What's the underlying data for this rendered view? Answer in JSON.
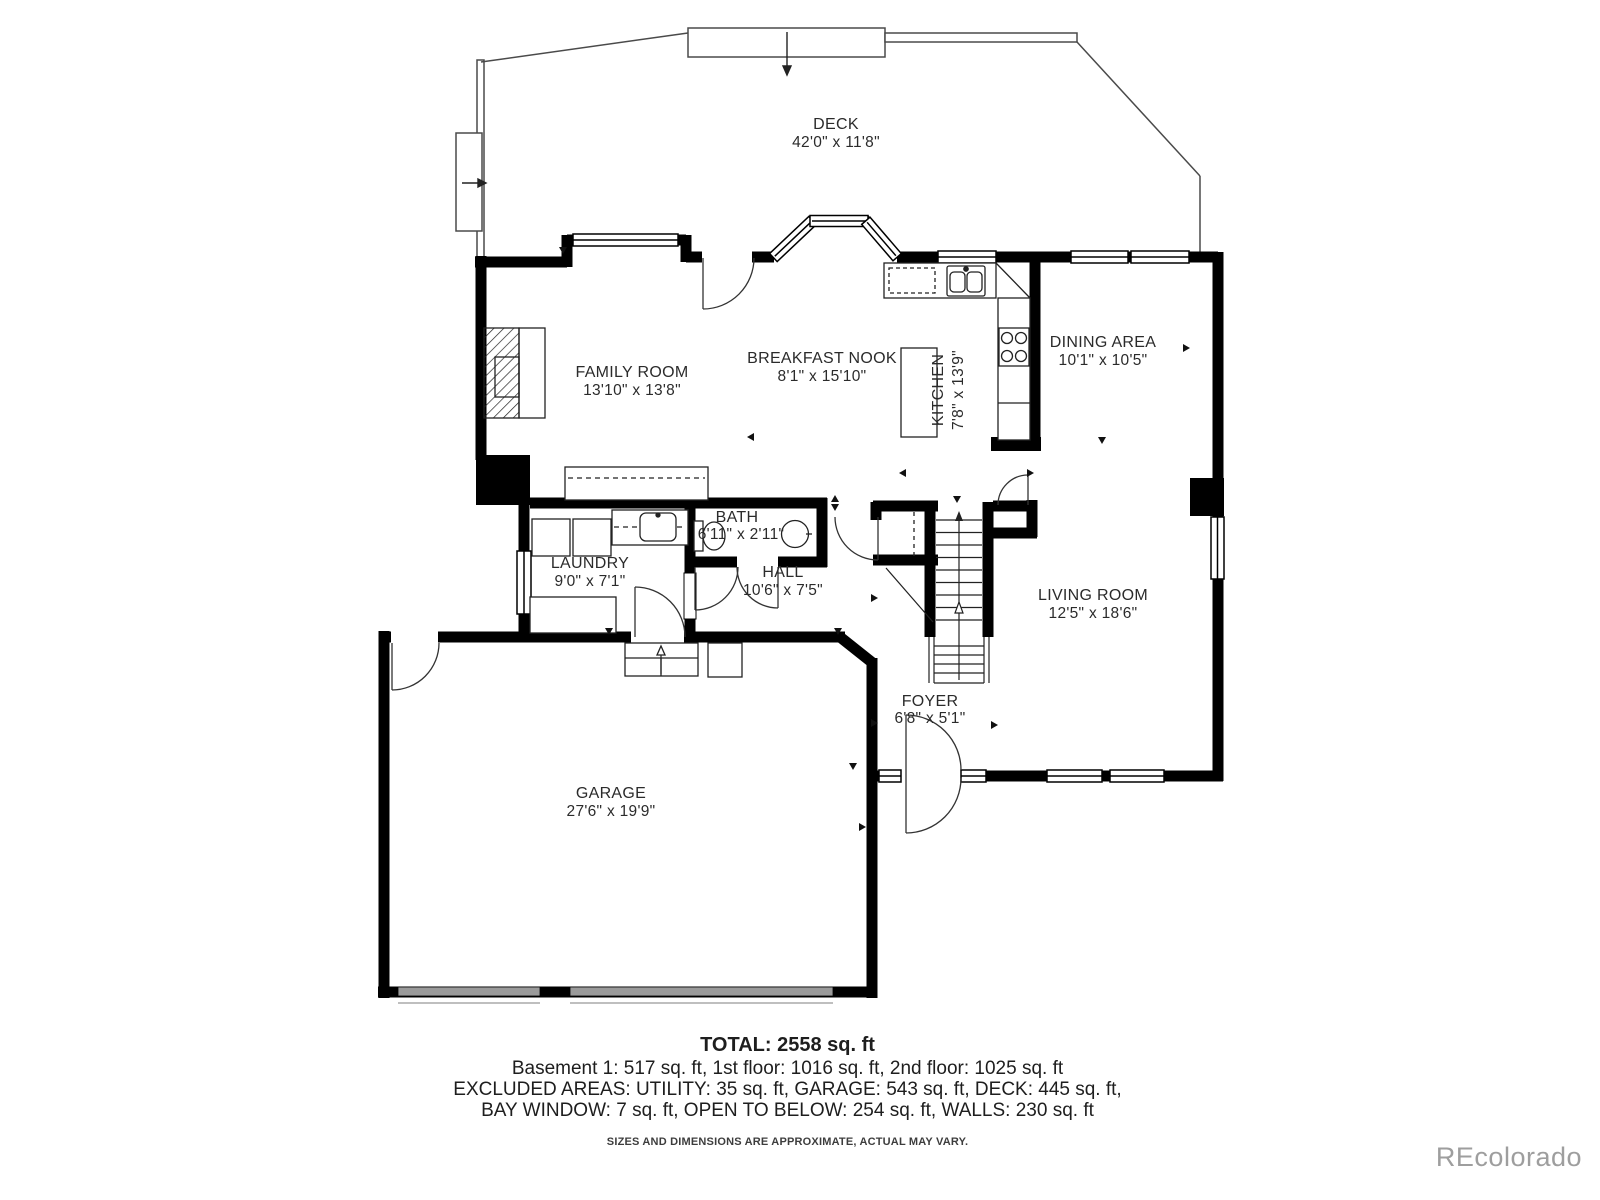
{
  "floorplan": {
    "rooms": [
      {
        "name": "DECK",
        "dims": "42'0\" x 11'8\""
      },
      {
        "name": "FAMILY ROOM",
        "dims": "13'10\" x 13'8\""
      },
      {
        "name": "BREAKFAST NOOK",
        "dims": "8'1\" x 15'10\""
      },
      {
        "name": "KITCHEN",
        "dims": "7'8\" x 13'9\""
      },
      {
        "name": "DINING AREA",
        "dims": "10'1\" x 10'5\""
      },
      {
        "name": "BATH",
        "dims": "6'11\" x 2'11\""
      },
      {
        "name": "LAUNDRY",
        "dims": "9'0\" x 7'1\""
      },
      {
        "name": "HALL",
        "dims": "10'6\" x 7'5\""
      },
      {
        "name": "LIVING ROOM",
        "dims": "12'5\" x 18'6\""
      },
      {
        "name": "FOYER",
        "dims": "6'8\" x 5'1\""
      },
      {
        "name": "GARAGE",
        "dims": "27'6\" x 19'9\""
      }
    ],
    "wall_color": "#000000",
    "garage_door_color": "#9a9a9a"
  },
  "summary": {
    "total": "TOTAL: 2558 sq. ft",
    "floors": "Basement 1: 517 sq. ft, 1st floor: 1016 sq. ft, 2nd floor: 1025 sq. ft",
    "excluded": "EXCLUDED AREAS: UTILITY: 35 sq. ft, GARAGE: 543 sq. ft, DECK: 445 sq. ft,",
    "excluded2": "BAY WINDOW: 7 sq. ft, OPEN TO BELOW: 254 sq. ft, WALLS: 230 sq. ft",
    "disclaimer": "SIZES AND DIMENSIONS ARE APPROXIMATE, ACTUAL MAY VARY."
  },
  "watermark": "REcolorado"
}
